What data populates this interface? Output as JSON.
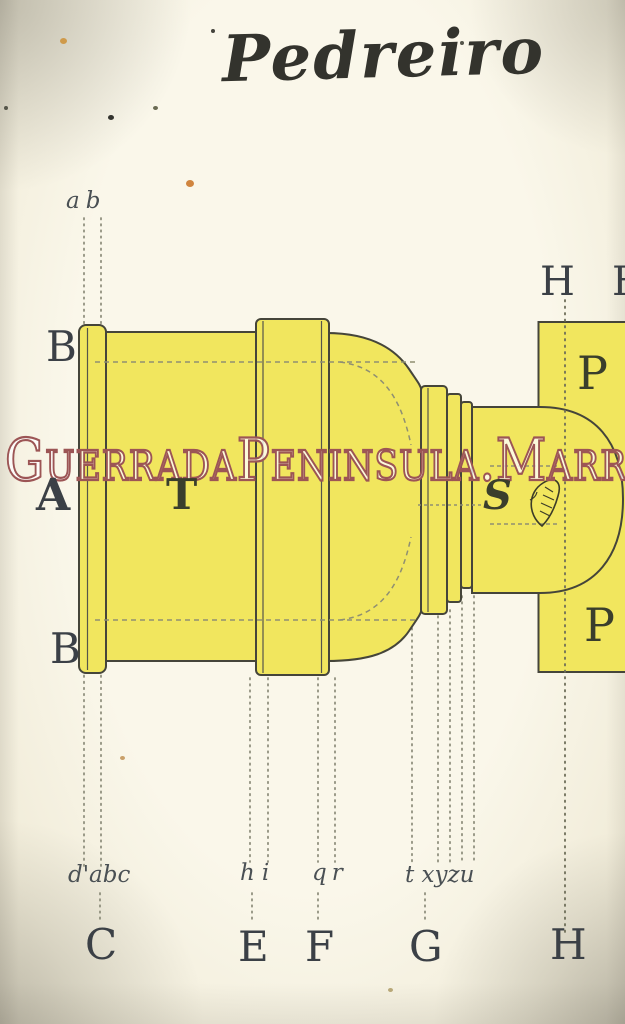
{
  "plate": {
    "title": "Pedreiro",
    "watermark": "GuerradaPeninsula.Marr",
    "labels": {
      "ab_top": "ab",
      "B_upper": "B",
      "A_left": "A",
      "B_lower": "B",
      "T_body": "T",
      "S_neck": "S",
      "H_top": "H",
      "H_top_partial": "H",
      "P_upper": "P",
      "P_lower": "P",
      "dabc_bottom": "d'abc",
      "hi_bottom": "hi",
      "qr_bottom": "qr",
      "txyzu_bottom": "t xyzu",
      "C_bottom": "C",
      "E_bottom": "E",
      "F_bottom": "F",
      "G_bottom": "G",
      "H_bottom": "H"
    },
    "palette": {
      "paper": "#f8f4e6",
      "drawing_yellow": "#f1e65e",
      "outline_ink": "#45453a",
      "letter_ink": "#3b4046",
      "guide_dot": "#8a8a78",
      "watermark_stroke": "#9c5555",
      "watermark_fill": "rgba(255,255,255,0.78)"
    }
  }
}
